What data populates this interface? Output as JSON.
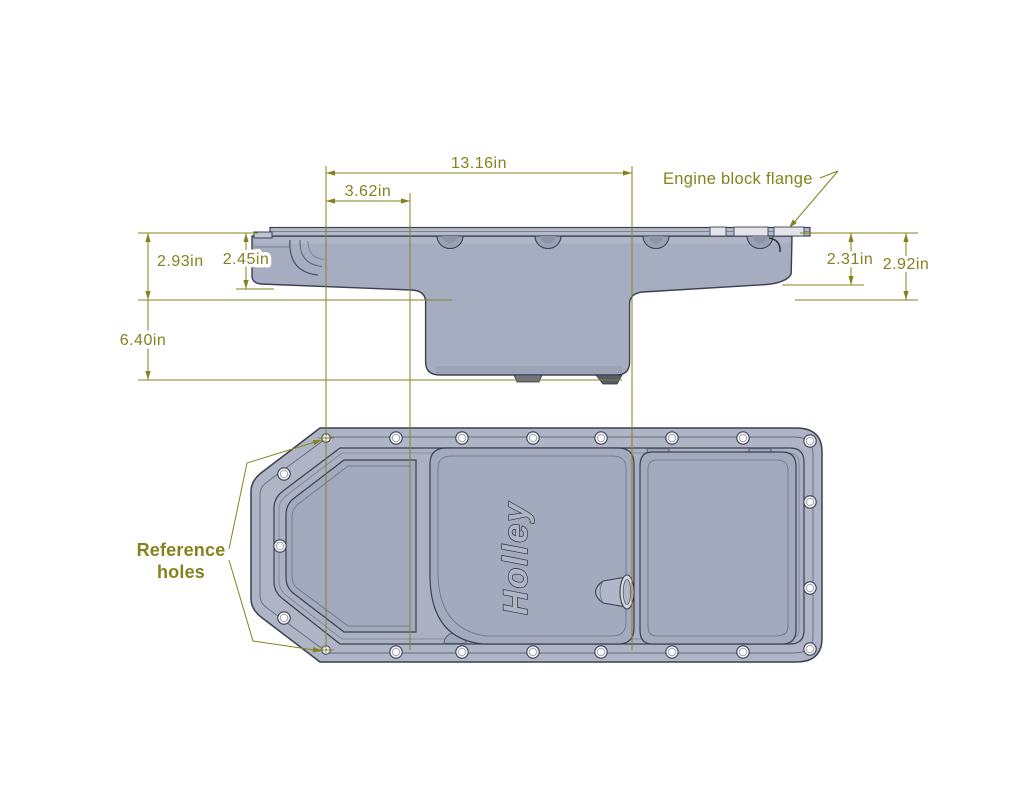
{
  "drawing": {
    "logo": "Holley",
    "labels": {
      "engine_block_flange": "Engine block flange",
      "reference_holes_line1": "Reference",
      "reference_holes_line2": "holes"
    },
    "dimensions": {
      "overall_length": "13.16in",
      "front_offset": "3.62in",
      "front_depth_outer": "2.93in",
      "front_depth_inner": "2.45in",
      "overall_depth": "6.40in",
      "rear_depth_inner": "2.31in",
      "rear_depth_outer": "2.92in"
    },
    "colors": {
      "annotation": "#85821d",
      "pan_body": "#a7adc0",
      "pan_outline": "#39404f",
      "background": "#ffffff"
    }
  }
}
